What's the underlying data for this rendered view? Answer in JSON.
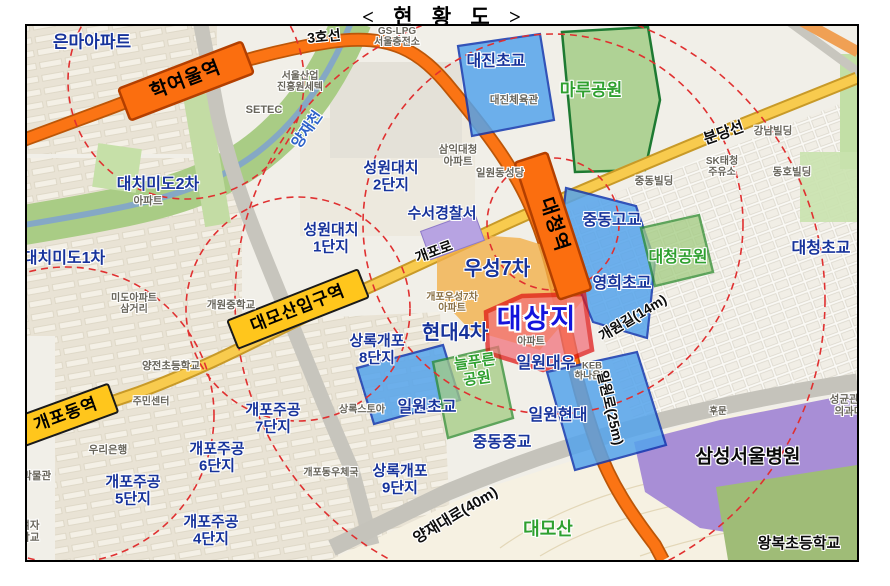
{
  "title": "< 현 황 도 >",
  "colors": {
    "line3_orange": "#FB7414",
    "bundang_yellow": "#F8CB4E",
    "station_yellow": "#FFC61C",
    "target_red_border": "#E01414",
    "target_red_fill": "#F26E78",
    "school_zone_blue": "#4E9FE8",
    "park_green": "#BBDD9E",
    "hospital_purple": "#A88ED6",
    "radius_ring_red": "#E03030",
    "navy_label": "#17339B",
    "green_label": "#2FA02F"
  },
  "map": {
    "labels": [
      {
        "name": "line3-label",
        "text": "3호선",
        "x": 324,
        "y": 37,
        "rot": -6,
        "size": 14,
        "cls": "road"
      },
      {
        "name": "gs-lpg-label",
        "text": "GS-LPG\n서울충전소",
        "x": 397,
        "y": 37,
        "rot": 0,
        "size": 10,
        "cls": "gray"
      },
      {
        "name": "eunma-apt-label",
        "text": "은마아파트",
        "x": 92,
        "y": 43,
        "rot": 0,
        "size": 17,
        "cls": "navy"
      },
      {
        "name": "daejin-elementary-label",
        "text": "대진초교",
        "x": 496,
        "y": 62,
        "rot": 0,
        "size": 16,
        "cls": "navy"
      },
      {
        "name": "maru-park-label",
        "text": "마루공원",
        "x": 591,
        "y": 91,
        "rot": 0,
        "size": 17,
        "cls": "green"
      },
      {
        "name": "seoul-business-agency-label",
        "text": "서울산업\n진흥원세텍",
        "x": 300,
        "y": 82,
        "rot": 0,
        "size": 10,
        "cls": "gray"
      },
      {
        "name": "daejin-gym-label",
        "text": "대진체육관",
        "x": 514,
        "y": 101,
        "rot": 0,
        "size": 10.5,
        "cls": "gray"
      },
      {
        "name": "setec-label",
        "text": "SETEC",
        "x": 264,
        "y": 110,
        "rot": 0,
        "size": 11,
        "cls": "gray"
      },
      {
        "name": "hakyeoul-station-label",
        "text": "학여울역",
        "x": 186,
        "y": 81,
        "rot": -21,
        "size": 19,
        "cls": "st"
      },
      {
        "name": "yangjaecheon-label",
        "text": "양재천",
        "x": 308,
        "y": 130,
        "rot": -55,
        "size": 15,
        "cls": "river"
      },
      {
        "name": "bundang-line-label",
        "text": "분당선",
        "x": 724,
        "y": 134,
        "rot": -19,
        "size": 15,
        "cls": "road"
      },
      {
        "name": "gangnam-building-label",
        "text": "강남빌딩",
        "x": 773,
        "y": 132,
        "rot": 0,
        "size": 10.5,
        "cls": "gray"
      },
      {
        "name": "sk-gas-station-label",
        "text": "SK태청\n주유소",
        "x": 722,
        "y": 167,
        "rot": 0,
        "size": 10,
        "cls": "gray"
      },
      {
        "name": "dongho-building-label",
        "text": "동호빌딩",
        "x": 792,
        "y": 173,
        "rot": 0,
        "size": 10.5,
        "cls": "gray"
      },
      {
        "name": "jungdong-building-label",
        "text": "중동빌딩",
        "x": 654,
        "y": 182,
        "rot": 0,
        "size": 10.5,
        "cls": "gray"
      },
      {
        "name": "samik-daecheong-apt-label",
        "text": "삼익대청\n아파트",
        "x": 458,
        "y": 156,
        "rot": 0,
        "size": 10.5,
        "cls": "gray"
      },
      {
        "name": "ilwon-cathedral-label",
        "text": "일원동성당",
        "x": 500,
        "y": 174,
        "rot": 0,
        "size": 10.5,
        "cls": "gray"
      },
      {
        "name": "seongwon-daechi2-label",
        "text": "성원대치\n2단지",
        "x": 391,
        "y": 177,
        "rot": 0,
        "size": 15,
        "cls": "navy"
      },
      {
        "name": "daechi-mido2-label",
        "text": "대치미도2차",
        "x": 158,
        "y": 185,
        "rot": 0,
        "size": 16,
        "cls": "navy"
      },
      {
        "name": "daechi-mido2-apt-label",
        "text": "아파트",
        "x": 148,
        "y": 202,
        "rot": 0,
        "size": 10.5,
        "cls": "gray"
      },
      {
        "name": "daecheong-station-label",
        "text": "대청역",
        "x": 553,
        "y": 225,
        "rot": 72,
        "size": 19,
        "cls": "st"
      },
      {
        "name": "jungdong-high-label",
        "text": "중동고교",
        "x": 612,
        "y": 221,
        "rot": 0,
        "size": 16,
        "cls": "navy"
      },
      {
        "name": "suseo-police-label",
        "text": "수서경찰서",
        "x": 442,
        "y": 214,
        "rot": 0,
        "size": 15,
        "cls": "navy"
      },
      {
        "name": "seongwon-daechi1-label",
        "text": "성원대치\n1단지",
        "x": 331,
        "y": 239,
        "rot": 0,
        "size": 15,
        "cls": "navy"
      },
      {
        "name": "gaepo-ro-label",
        "text": "개포로",
        "x": 434,
        "y": 252,
        "rot": -20,
        "size": 14,
        "cls": "road"
      },
      {
        "name": "daechi-mido1-label",
        "text": "대치미도1차",
        "x": 64,
        "y": 259,
        "rot": 0,
        "size": 16,
        "cls": "navy"
      },
      {
        "name": "woosung7-label",
        "text": "우성7차",
        "x": 497,
        "y": 269,
        "rot": 0,
        "size": 20,
        "cls": "navy"
      },
      {
        "name": "daecheong-park-label",
        "text": "대청공원",
        "x": 678,
        "y": 258,
        "rot": 0,
        "size": 16,
        "cls": "green"
      },
      {
        "name": "daecheong-elementary-label",
        "text": "대청초교",
        "x": 821,
        "y": 249,
        "rot": 0,
        "size": 16,
        "cls": "navy"
      },
      {
        "name": "yeonghee-elementary-label",
        "text": "영희초교",
        "x": 622,
        "y": 284,
        "rot": 0,
        "size": 16,
        "cls": "navy"
      },
      {
        "name": "mido-samgeori-label",
        "text": "미도아파트\n삼거리",
        "x": 134,
        "y": 304,
        "rot": 0,
        "size": 10,
        "cls": "gray"
      },
      {
        "name": "gaewon-middle-school-label",
        "text": "개원중학교",
        "x": 231,
        "y": 306,
        "rot": 0,
        "size": 10.5,
        "cls": "gray"
      },
      {
        "name": "daemosan-entrance-station-label",
        "text": "대모산입구역",
        "x": 298,
        "y": 309,
        "rot": -21.5,
        "size": 17,
        "cls": "st"
      },
      {
        "name": "gaewon-gil-label",
        "text": "개원길(14m)",
        "x": 633,
        "y": 318,
        "rot": -31,
        "size": 14,
        "cls": "road"
      },
      {
        "name": "gaepo-woosung7-apt-label",
        "text": "개포우성7차\n아파트",
        "x": 452,
        "y": 303,
        "rot": 0,
        "size": 10,
        "cls": "tan"
      },
      {
        "name": "target-site-label",
        "text": "대상지",
        "x": 537,
        "y": 320,
        "rot": 0,
        "size": 27,
        "cls": "target"
      },
      {
        "name": "target-apt-label",
        "text": "아파트",
        "x": 531,
        "y": 342,
        "rot": 0,
        "size": 10,
        "cls": "gray"
      },
      {
        "name": "hyundai4-label",
        "text": "현대4차",
        "x": 455,
        "y": 333,
        "rot": 0,
        "size": 20,
        "cls": "navy"
      },
      {
        "name": "sangnok-gaepo8-label",
        "text": "상록개포\n8단지",
        "x": 377,
        "y": 350,
        "rot": 0,
        "size": 15,
        "cls": "navy"
      },
      {
        "name": "neulpureun-park-label",
        "text": "늘푸른\n공원",
        "x": 476,
        "y": 371,
        "rot": -8,
        "size": 15,
        "cls": "green"
      },
      {
        "name": "ilwon-daewoo-label",
        "text": "일원대우",
        "x": 546,
        "y": 364,
        "rot": 0,
        "size": 16,
        "cls": "navy"
      },
      {
        "name": "keb-hana-bank-label",
        "text": "KEB\n하나은행",
        "x": 592,
        "y": 372,
        "rot": 0,
        "size": 9.5,
        "cls": "gray"
      },
      {
        "name": "yangjeon-elementary-label",
        "text": "양전초등학교",
        "x": 171,
        "y": 367,
        "rot": 0,
        "size": 10.5,
        "cls": "gray"
      },
      {
        "name": "community-center-label",
        "text": "주민센터",
        "x": 151,
        "y": 402,
        "rot": 0,
        "size": 10,
        "cls": "gray"
      },
      {
        "name": "ilwon-elementary-label",
        "text": "일원초교",
        "x": 427,
        "y": 408,
        "rot": 0,
        "size": 16,
        "cls": "navy"
      },
      {
        "name": "sangnok-store-label",
        "text": "상록스토아",
        "x": 362,
        "y": 410,
        "rot": 0,
        "size": 10,
        "cls": "gray"
      },
      {
        "name": "ilwon-hyundai-label",
        "text": "일원현대",
        "x": 558,
        "y": 416,
        "rot": 0,
        "size": 16,
        "cls": "navy"
      },
      {
        "name": "ilwon-ro-label",
        "text": "일원로(25m)",
        "x": 610,
        "y": 408,
        "rot": 77,
        "size": 14,
        "cls": "road"
      },
      {
        "name": "sungkyunkwan-med-label",
        "text": "성균관대\n의과대",
        "x": 849,
        "y": 406,
        "rot": 0,
        "size": 10.5,
        "cls": "gray"
      },
      {
        "name": "ilwon-community-center-label",
        "text": "일원\n주민센터",
        "x": 876,
        "y": 306,
        "rot": 0,
        "size": 10.5,
        "cls": "gray"
      },
      {
        "name": "rear-gate-label",
        "text": "후문",
        "x": 718,
        "y": 412,
        "rot": 0,
        "size": 9.5,
        "cls": "gray"
      },
      {
        "name": "gaepodong-station-label",
        "text": "개포동역",
        "x": 66,
        "y": 415,
        "rot": -20,
        "size": 17,
        "cls": "st"
      },
      {
        "name": "gaepo-jugong7-label",
        "text": "개포주공\n7단지",
        "x": 273,
        "y": 419,
        "rot": 0,
        "size": 15,
        "cls": "navy"
      },
      {
        "name": "jungdong-middle-label",
        "text": "중동중교",
        "x": 502,
        "y": 443,
        "rot": 0,
        "size": 16,
        "cls": "navy"
      },
      {
        "name": "woori-bank-label",
        "text": "우리은행",
        "x": 108,
        "y": 451,
        "rot": 0,
        "size": 10.5,
        "cls": "gray"
      },
      {
        "name": "gaepo-jugong6-label",
        "text": "개포주공\n6단지",
        "x": 217,
        "y": 458,
        "rot": 0,
        "size": 15,
        "cls": "navy"
      },
      {
        "name": "samsung-hospital-label",
        "text": "삼성서울병원",
        "x": 748,
        "y": 458,
        "rot": 0,
        "size": 19,
        "cls": "black"
      },
      {
        "name": "gyeongun-museum-label",
        "text": "경운박물관",
        "x": 27,
        "y": 477,
        "rot": 0,
        "size": 10.5,
        "cls": "gray"
      },
      {
        "name": "gaepo-post-office-label",
        "text": "개포동우체국",
        "x": 331,
        "y": 473,
        "rot": 0,
        "size": 10,
        "cls": "gray"
      },
      {
        "name": "sangnok-gaepo9-label",
        "text": "상록개포\n9단지",
        "x": 400,
        "y": 480,
        "rot": 0,
        "size": 15,
        "cls": "navy"
      },
      {
        "name": "gaepo-jugong5-label",
        "text": "개포주공\n5단지",
        "x": 133,
        "y": 491,
        "rot": 0,
        "size": 15,
        "cls": "navy"
      },
      {
        "name": "yangjae-daero-label",
        "text": "양재대로(40m)",
        "x": 456,
        "y": 516,
        "rot": -31,
        "size": 15,
        "cls": "road"
      },
      {
        "name": "girls-school-clipped-label",
        "text": "기여자\n등학교",
        "x": 25,
        "y": 532,
        "rot": 0,
        "size": 10.5,
        "cls": "gray"
      },
      {
        "name": "daemosan-label",
        "text": "대모산",
        "x": 548,
        "y": 530,
        "rot": 0,
        "size": 18,
        "cls": "green"
      },
      {
        "name": "gaepo-jugong4-label",
        "text": "개포주공\n4단지",
        "x": 211,
        "y": 531,
        "rot": 0,
        "size": 15,
        "cls": "navy"
      },
      {
        "name": "wangbok-elementary-label",
        "text": "왕복초등학교",
        "x": 799,
        "y": 544,
        "rot": 0,
        "size": 15,
        "cls": "black"
      }
    ]
  }
}
